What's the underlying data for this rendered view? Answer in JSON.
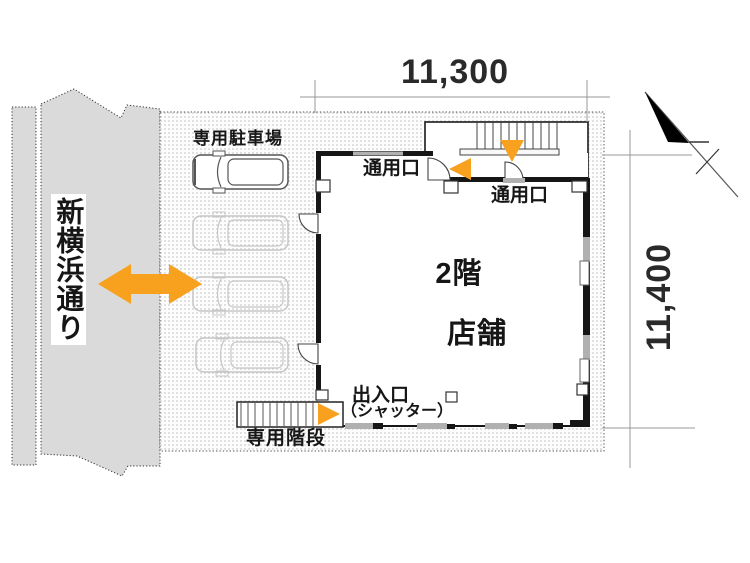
{
  "street_label": "新横浜通り",
  "parking": {
    "label": "専用駐車場"
  },
  "building": {
    "floor_label_line1": "2階",
    "floor_label_line2": "店舗",
    "service_entrance_left": "通用口",
    "service_entrance_top": "通用口",
    "exit_label_line1": "出入口",
    "exit_label_line2": "（シャッター）",
    "private_stairs_label": "専用階段"
  },
  "dimensions": {
    "top_width": "11,300",
    "right_height": "11,400"
  },
  "colors": {
    "accent_orange": "#F7A11E",
    "road_fill": "#DADADA",
    "wall": "#161616",
    "window_gray": "#B0B0B0",
    "dimension_gray": "#999999"
  }
}
